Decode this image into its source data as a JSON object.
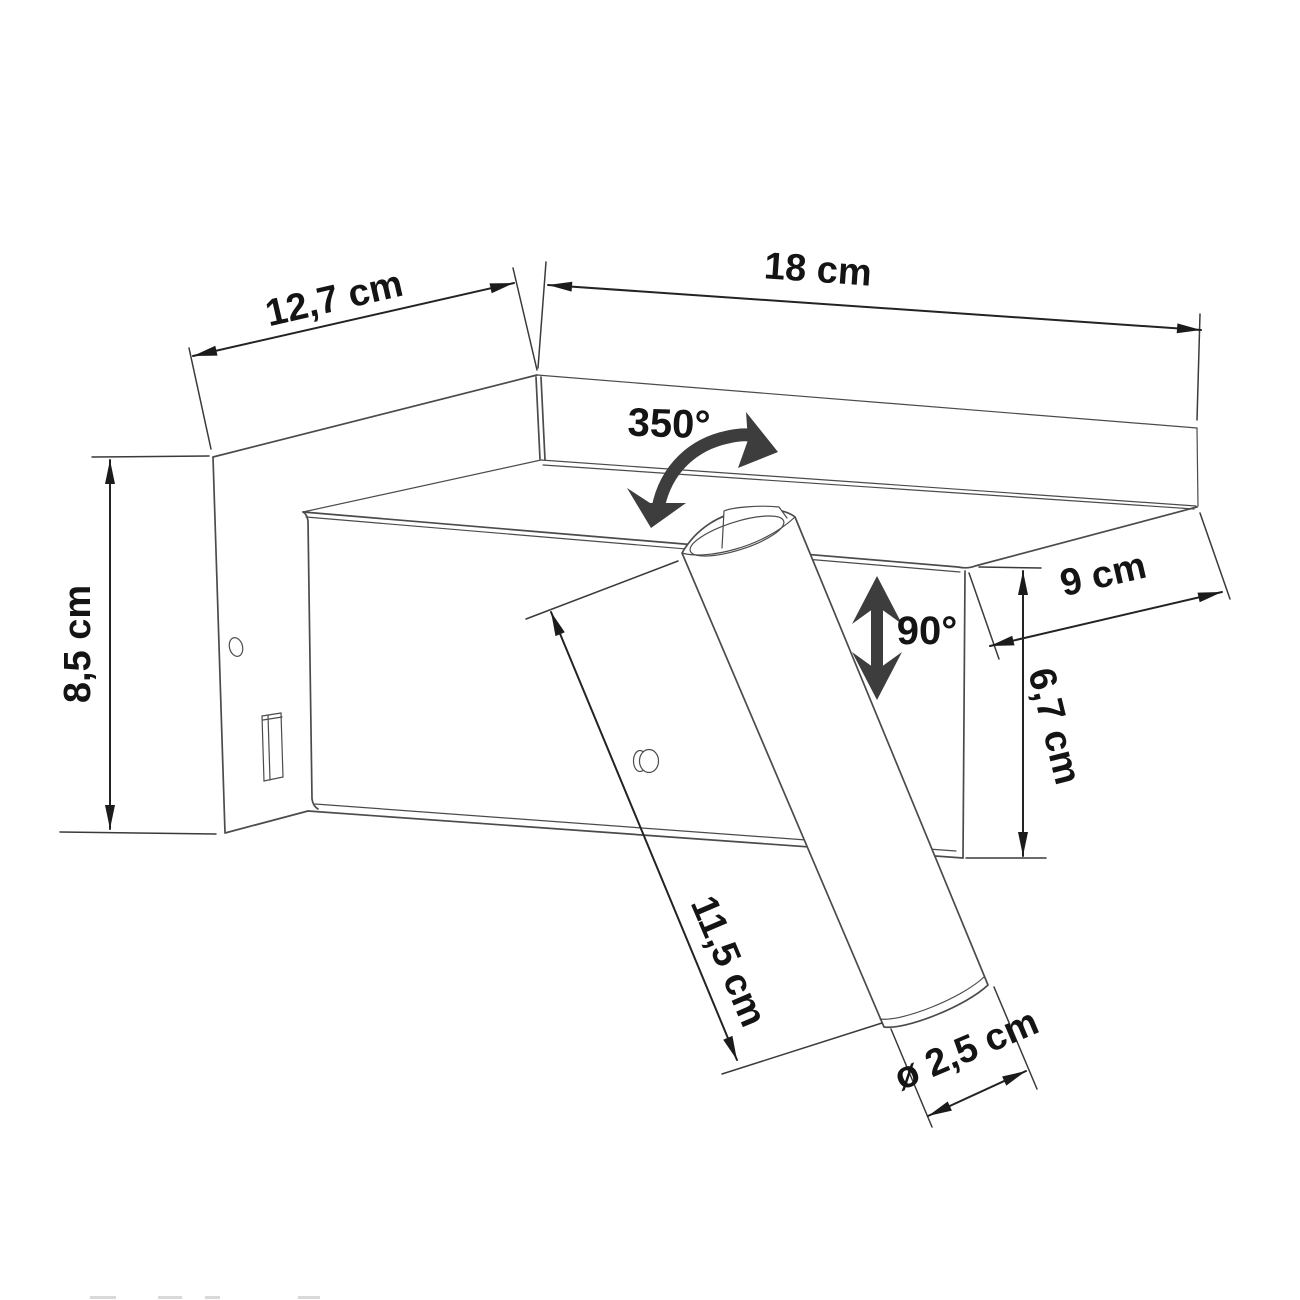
{
  "drawing": {
    "subject": "wall reading lamp with shelf - dimensional line drawing"
  },
  "style": {
    "background": "#ffffff",
    "product_line_color": "#4b4b4b",
    "dimension_line_color": "#232323",
    "text_color": "#141414",
    "rotation_arrow_color": "#3d3d3d"
  },
  "dimensions": {
    "plate_depth": "12,7 cm",
    "total_width": "18 cm",
    "plate_height": "8,5 cm",
    "shelf_depth": "9 cm",
    "housing_height": "6,7 cm",
    "spot_length": "11,5 cm",
    "spot_diameter": "ø 2,5 cm"
  },
  "angles": {
    "swivel": "350°",
    "tilt": "90°"
  }
}
